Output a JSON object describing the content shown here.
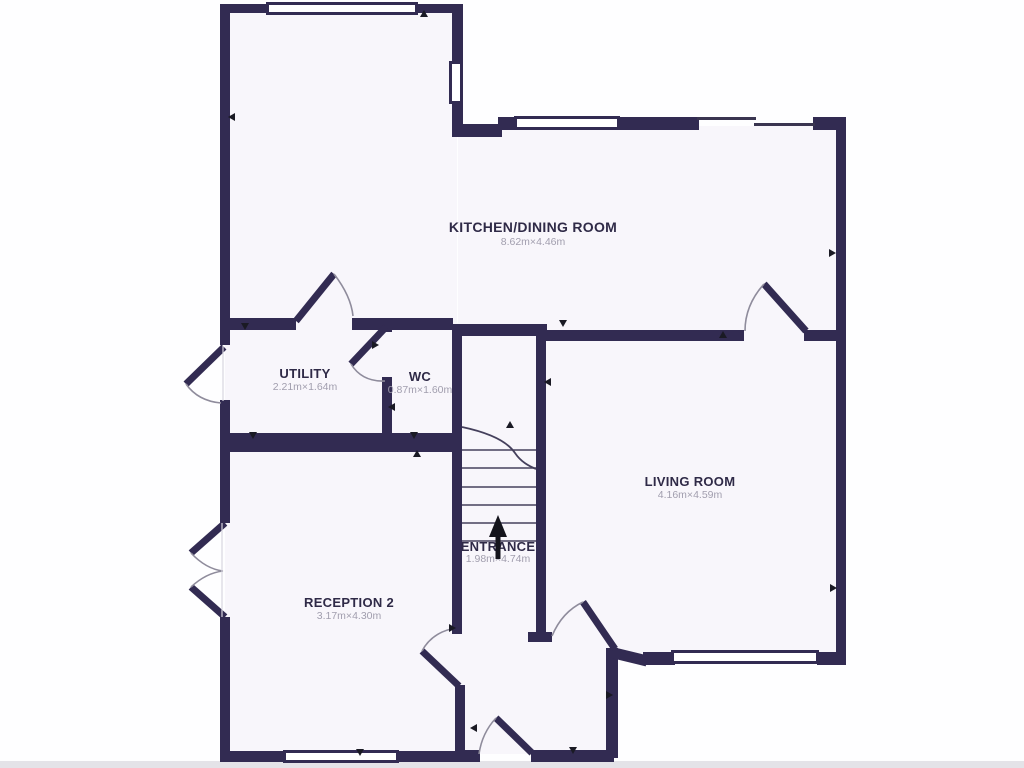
{
  "floorplan": {
    "rooms": {
      "kitchen": {
        "name": "KITCHEN/DINING ROOM",
        "dimensions": "8.62m×4.46m"
      },
      "utility": {
        "name": "UTILITY",
        "dimensions": "2.21m×1.64m"
      },
      "wc": {
        "name": "WC",
        "dimensions": "0.87m×1.60m"
      },
      "living": {
        "name": "LIVING ROOM",
        "dimensions": "4.16m×4.59m"
      },
      "reception": {
        "name": "RECEPTION 2",
        "dimensions": "3.17m×4.30m"
      },
      "entrance": {
        "name": "ENTRANCE",
        "dimensions": "1.98m×4.74m"
      }
    },
    "colors": {
      "wall": "#322b52",
      "floor": "#f8f6fb",
      "dimension_text": "#a19eae",
      "door_arc": "#8f8c9c"
    },
    "icons": [
      "stairs-up-arrow-icon"
    ]
  }
}
